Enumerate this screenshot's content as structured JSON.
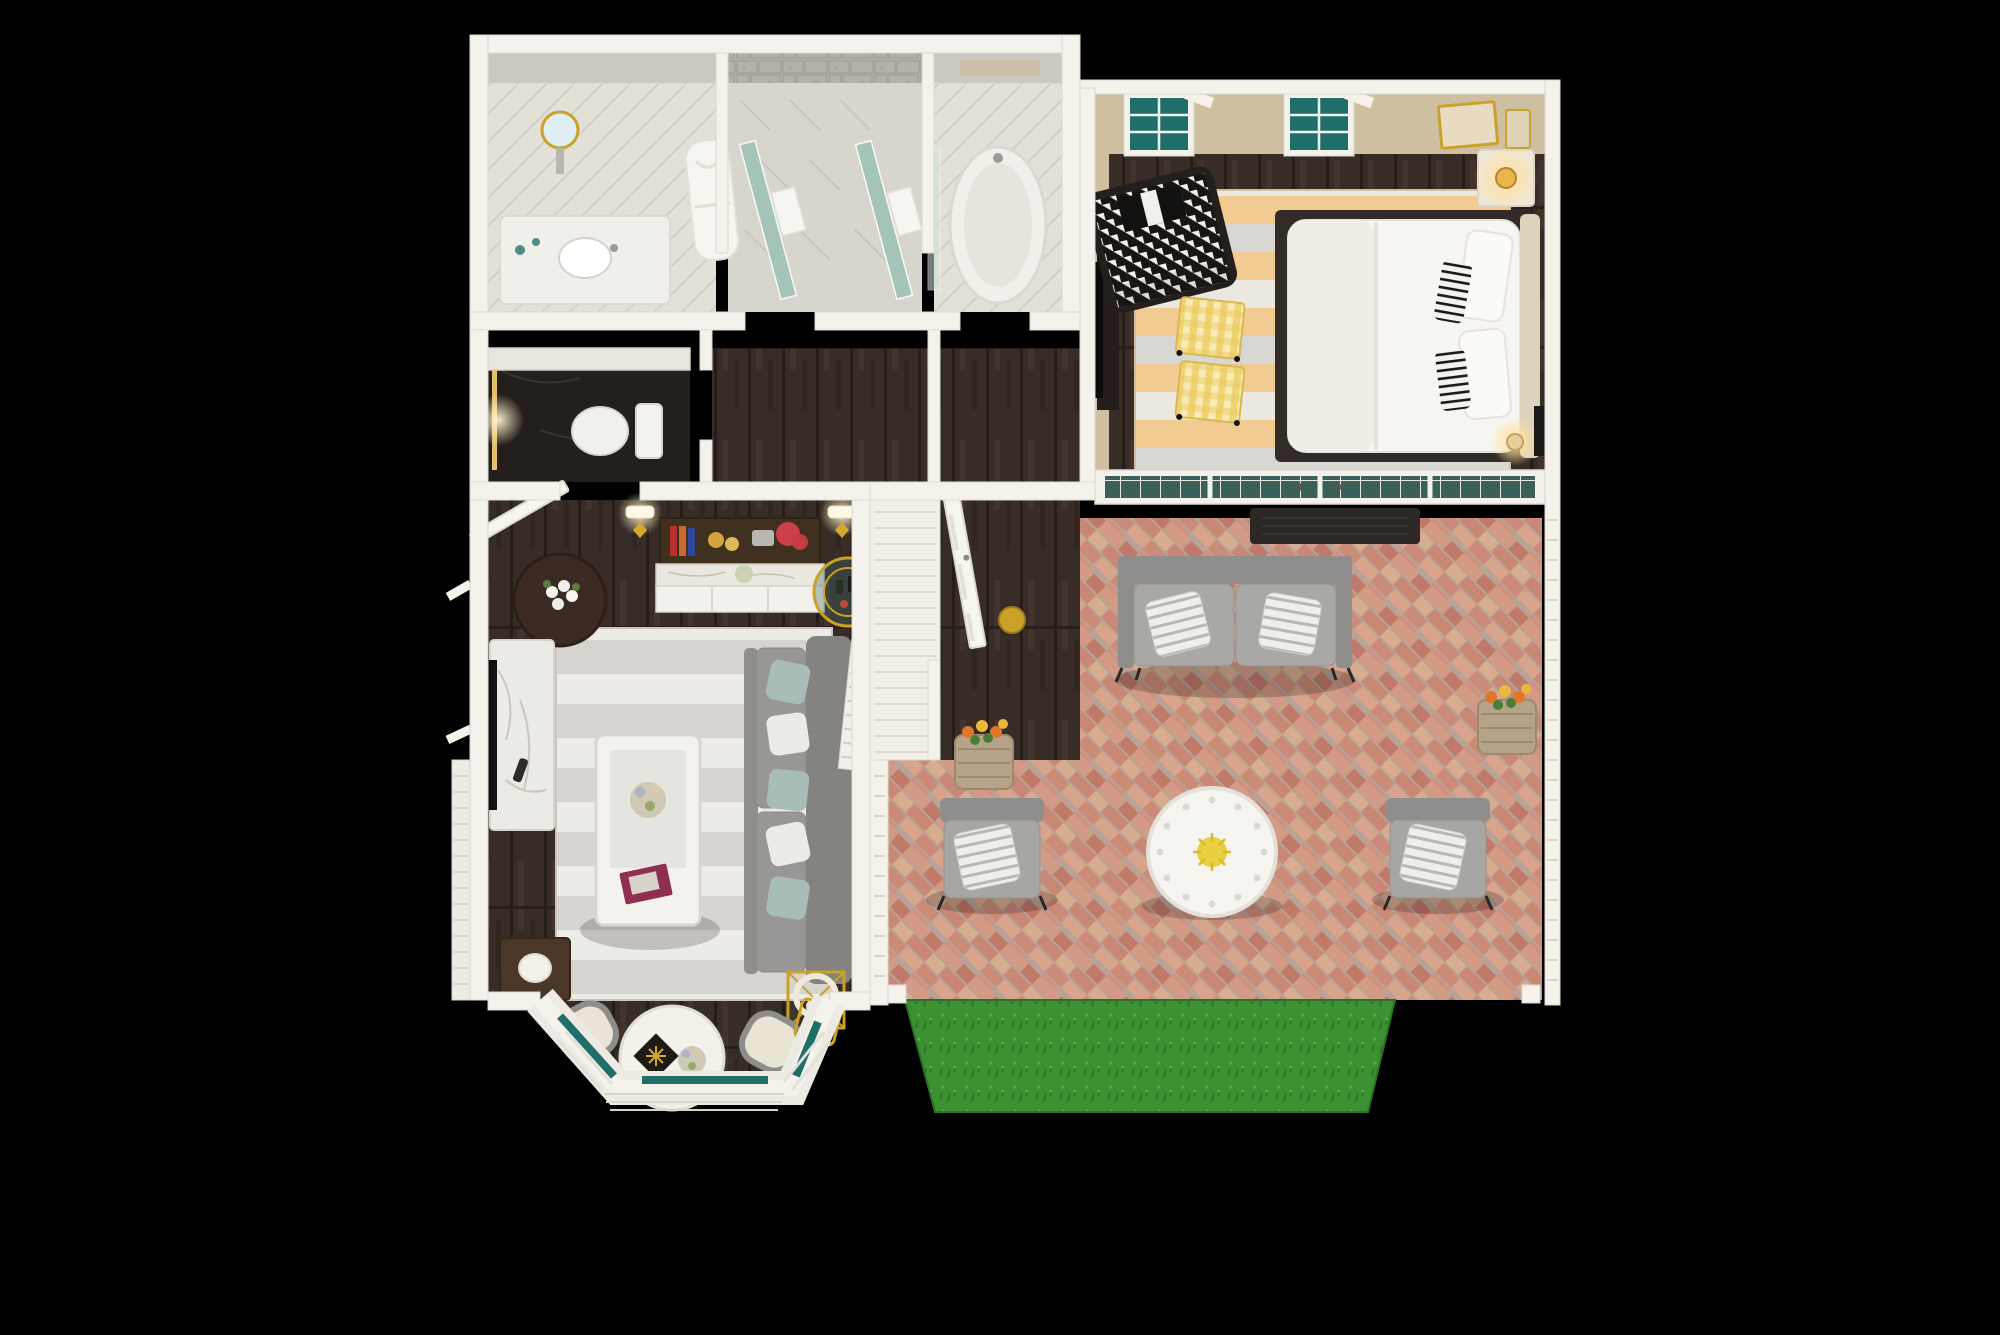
{
  "scene": {
    "title": "3D dollhouse-style floor plan render of a one-bedroom suite with patio",
    "view": "top-down cutaway on black background",
    "rooms": [
      {
        "id": "master-bathroom",
        "label": "Master bathroom",
        "items": [
          "walk-in shower with two green glass partitions",
          "stone tile shower walls",
          "white bathrobe hanging on wall",
          "vanity with sink and faucet",
          "round gold magnifying mirror",
          "freestanding bathtub",
          "white towels on glass panels",
          "light tile floor"
        ]
      },
      {
        "id": "water-closet",
        "label": "Water closet",
        "items": [
          "toilet",
          "dark marble floor",
          "marble ledge",
          "lighted gold mirror strip",
          "beige walls"
        ]
      },
      {
        "id": "hallway",
        "label": "Hallway",
        "items": [
          "open white paneled door",
          "sliding closet panel",
          "lit wall sconces",
          "gold bowl on floor",
          "dark hardwood floor",
          "corridor to patio"
        ]
      },
      {
        "id": "living-room",
        "label": "Living room",
        "items": [
          "built-in shelf with red coral, books and gold pears",
          "marble-top cabinet with white paneled doors",
          "gold bar cart with bottles",
          "gray fabric sofa with teal and white pillows",
          "gray striped area rug",
          "white coffee table with flower vase and maroon magazine",
          "gold cube side table with white ring lamp",
          "dark end table with white lamp",
          "marble console with wall TV and remote",
          "round dark wood side table with white roses",
          "casement windows with teal glass",
          "bay window with white shutters",
          "round white dining table with centerpiece and gold starburst placemat",
          "two cream upholstered chairs",
          "gold metal chair",
          "white louvered shutter screen"
        ]
      },
      {
        "id": "bedroom",
        "label": "Bedroom",
        "items": [
          "platform bed with white bedding and dark base",
          "black-and-white striped accent pillows",
          "beige upholstered headboard",
          "two yellow gingham ottomans on casters",
          "black-and-white houndstooth settee with pillow",
          "striped rug in peach, gray and cream",
          "nightstand with glowing lamp",
          "gold wall frames",
          "dark media console with TV",
          "two casement windows with teal glass, sashes open",
          "French glass door wall to patio",
          "dark door mat",
          "sunlight patches on rug"
        ]
      },
      {
        "id": "patio",
        "label": "Patio",
        "items": [
          "herringbone brick pavers in pink and tan",
          "outdoor loveseat with gray cushions and two striped pillows",
          "two outdoor armchairs with striped pillows",
          "round white fretwork coffee table with yellow flowers",
          "two wicker planters with orange and yellow marigolds",
          "white louvered privacy walls and posts",
          "green lawn strip"
        ]
      }
    ]
  },
  "palette": {
    "background": "#000000",
    "wall": "#f5f2ec",
    "wallTan": "#cdbf9f",
    "woodDark": "#382c27",
    "rugLiving": "#d7d4cf",
    "rugPeach": "#f2cb92",
    "rugGray": "#d8d7d3",
    "rugCream": "#eae8df",
    "brick": "#cf8e7c",
    "grass": "#3c9132",
    "glassTeal": "#1f6f68",
    "showerGlass": "#9cc3b2",
    "marble": "#eceae5",
    "stone": "#b4b1a8",
    "gold": "#c9a227",
    "sofaGray": "#8c8b89",
    "charcoal": "#1c1917",
    "ottomanYellow": "#eccb5f"
  }
}
